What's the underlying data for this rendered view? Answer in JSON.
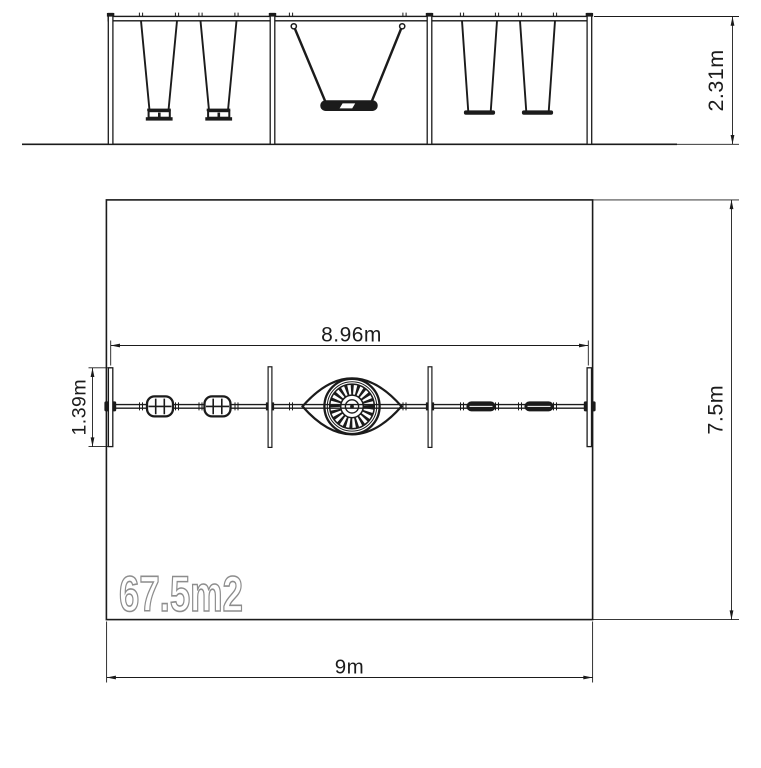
{
  "elevation": {
    "height_dim": "2.31m"
  },
  "plan": {
    "structure_width_dim": "8.96m",
    "frame_depth_dim": "1.39m",
    "zone_depth_dim": "7.5m",
    "zone_width_dim": "9m",
    "area_label": "67.5m2"
  },
  "colors": {
    "line": "#1b1b1b",
    "area_outline": "#8d8d8d",
    "background": "#ffffff"
  }
}
